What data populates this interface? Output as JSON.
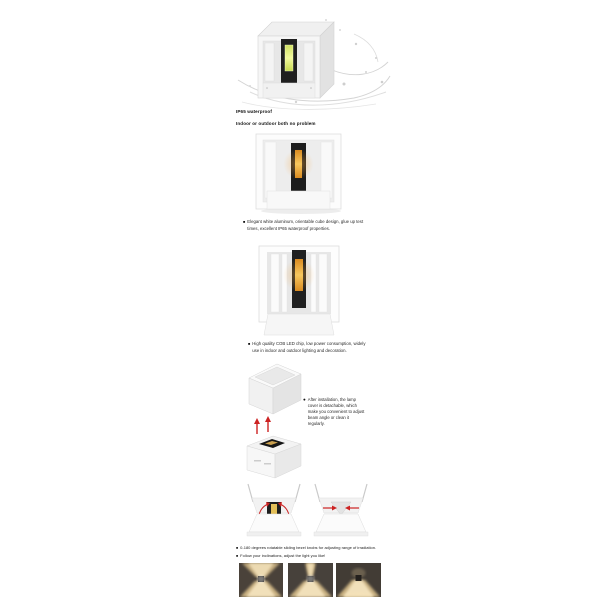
{
  "page_title": "Cube LED wall lamp product description",
  "colors": {
    "background": "#ffffff",
    "accent_red": "#cc2222",
    "led_orange": "#f0a63c",
    "led_green_yellow": "#e6ee7c",
    "beam_warm": "#f4d79b",
    "text": "#1c1c1c"
  },
  "section_waterproof": {
    "caption_line1": "IP65 waterproof",
    "caption_line2": "Indoor or outdoor both no problem",
    "image_alt": "cube-lamp-with-water-splash"
  },
  "section_design": {
    "bullet": "■",
    "text": "Elegant white aluminum, orientable cube design, glue up test times, excellent IP65 waterproof properties."
  },
  "section_cob": {
    "bullet": "■",
    "text": "High quality COB LED chip, low power consumption, widely use in indoor and outdoor lighting and decoration."
  },
  "section_detachable": {
    "bullet": "●",
    "text": "After installation, the lamp cover is detachable, which make you convenient to adjust beam angle or clean it regularly."
  },
  "section_adjust": {
    "bullet1": "■",
    "line1": "0-180 degrees rotatable sliding bezel knobs for adjusting range of irradiation.",
    "bullet2": "■",
    "line2": "Follow your inclinations, adjust the light you like!"
  }
}
